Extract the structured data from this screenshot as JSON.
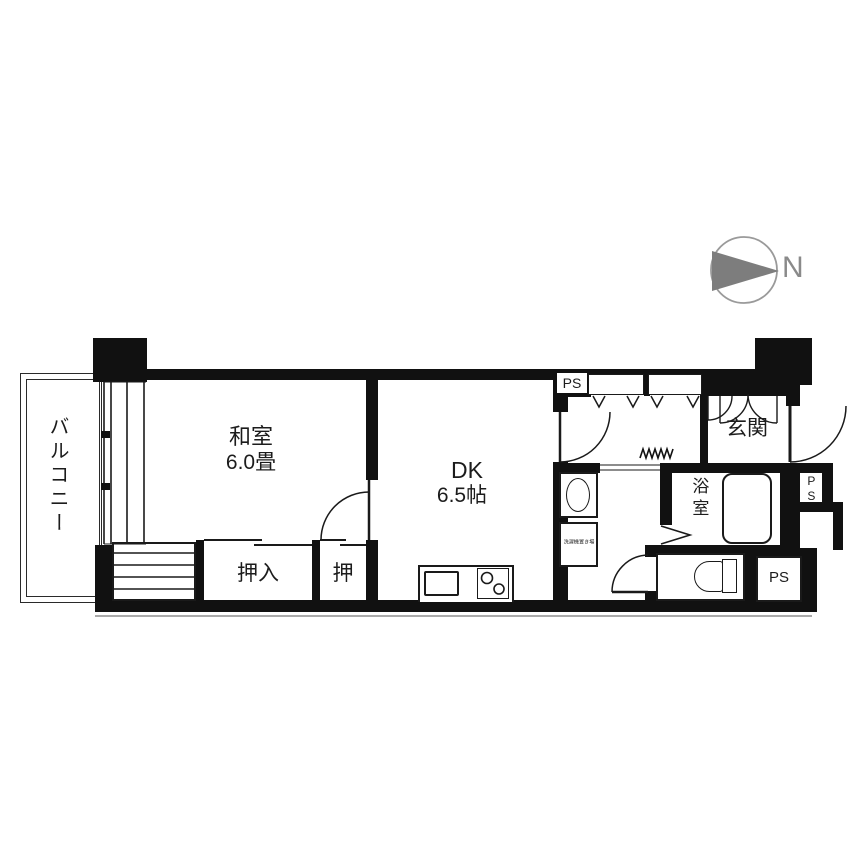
{
  "compass": {
    "north": "N"
  },
  "rooms": {
    "balcony": "バルコニー",
    "washitsu": {
      "name": "和室",
      "size": "6.0畳"
    },
    "dining_kitchen": {
      "name": "DK",
      "size": "6.5帖"
    },
    "closet_large": "押入",
    "closet_small": "押",
    "entrance": "玄関",
    "bathroom": "浴室",
    "laundry_space": "洗濯機置き場"
  },
  "pipe_spaces": {
    "top": "PS",
    "side": "PS",
    "bottom": "PS"
  },
  "colors": {
    "wall": "#111111",
    "line": "#1a1a1a",
    "compass_gray": "#8a8a8a"
  }
}
